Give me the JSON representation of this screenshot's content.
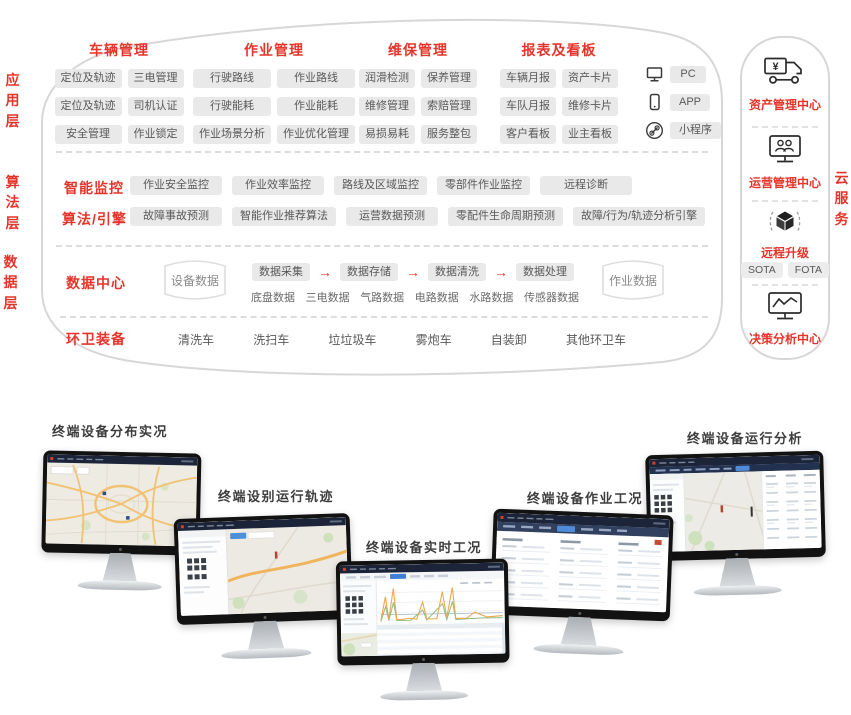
{
  "side_labels": {
    "app": "应用层",
    "algo": "算法层",
    "data": "数据层",
    "cloud": "云服务"
  },
  "app": {
    "groups": [
      {
        "title": "车辆管理",
        "pills": [
          "定位及轨迹",
          "三电管理",
          "定位及轨迹",
          "司机认证",
          "安全管理",
          "作业锁定"
        ]
      },
      {
        "title": "作业管理",
        "pills": [
          "行驶路线",
          "作业路线",
          "行驶能耗",
          "作业能耗",
          "作业场景分析",
          "作业优化管理"
        ]
      },
      {
        "title": "维保管理",
        "pills": [
          "润滑检测",
          "保养管理",
          "维修管理",
          "索赔管理",
          "易损易耗",
          "服务整包"
        ]
      },
      {
        "title": "报表及看板",
        "pills": [
          "车辆月报",
          "资产卡片",
          "车队月报",
          "维修卡片",
          "客户看板",
          "业主看板"
        ]
      }
    ],
    "platforms": [
      {
        "icon": "pc-icon",
        "label": "PC"
      },
      {
        "icon": "smartphone-icon",
        "label": "APP"
      },
      {
        "icon": "link-icon",
        "label": "小程序"
      }
    ]
  },
  "algo": {
    "rows": [
      {
        "title": "智能监控",
        "pills": [
          "作业安全监控",
          "作业效率监控",
          "路线及区域监控",
          "零部件作业监控",
          "远程诊断"
        ]
      },
      {
        "title": "算法/引擎",
        "pills": [
          "故障事故预测",
          "智能作业推荐算法",
          "运营数据预测",
          "零配件生命周期预测",
          "故障/行为/轨迹分析引擎"
        ]
      }
    ]
  },
  "data_layer": {
    "title": "数据中心",
    "device_db": "设备数据",
    "job_db": "作业数据",
    "flow": [
      "数据采集",
      "数据存储",
      "数据清洗",
      "数据处理"
    ],
    "arrow": "→",
    "sources": [
      "底盘数据",
      "三电数据",
      "气路数据",
      "电路数据",
      "水路数据",
      "传感器数据"
    ],
    "equipment_title": "环卫装备",
    "equipment": [
      "清洗车",
      "洗扫车",
      "垃垃圾车",
      "雾炮车",
      "自装卸",
      "其他环卫车"
    ]
  },
  "cloud": {
    "sections": [
      {
        "icon": "truck-yen-icon",
        "label": "资产管理中心"
      },
      {
        "icon": "monitor-users-icon",
        "label": "运营管理中心"
      },
      {
        "icon": "cube-icon",
        "label": "远程升级",
        "pills": [
          "SOTA",
          "FOTA"
        ]
      },
      {
        "icon": "monitor-chart-icon",
        "label": "决策分析中心"
      }
    ]
  },
  "monitors": [
    {
      "label": "终端设备分布实况"
    },
    {
      "label": "终端设别运行轨迹"
    },
    {
      "label": "终端设备实时工况"
    },
    {
      "label": "终端设备作业工况"
    },
    {
      "label": "终端设备运行分析"
    }
  ],
  "colors": {
    "accent_red": "#e5352b",
    "pill_bg": "#e9e9e9",
    "pill_text": "#595959",
    "screen_navy": "#1b2438",
    "map_beige": "#edeae2",
    "road_orange": "#f1c272",
    "active_blue": "#3f7fd6"
  }
}
